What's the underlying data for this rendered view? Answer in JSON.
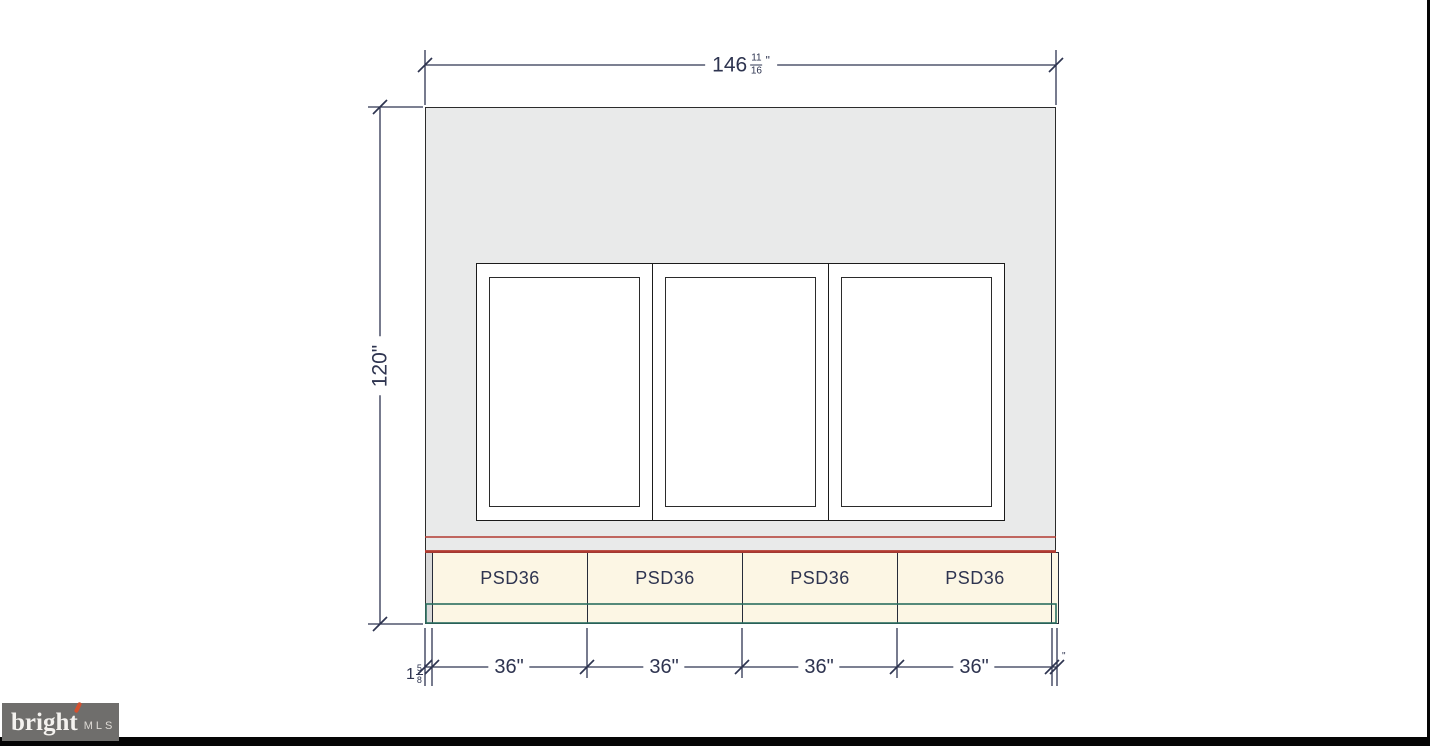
{
  "drawing": {
    "colors": {
      "dim_line": "#2e3450",
      "red_accent": "#b23b31",
      "teal_accent": "#2a6e5f",
      "wall_fill": "#e9eaea",
      "cabinet_fill": "#fcf6e4"
    },
    "dimensions": {
      "top_width": {
        "whole": "146",
        "numerator": "11",
        "denominator": "16",
        "unit": "\""
      },
      "wall_height": "120\"",
      "cabinet_widths": [
        "36\"",
        "36\"",
        "36\"",
        "36\""
      ],
      "left_filler": {
        "whole": "1",
        "numerator": "5",
        "denominator": "8",
        "unit": "\""
      },
      "right_filler_mark": "\""
    },
    "cabinets": [
      {
        "label": "PSD36"
      },
      {
        "label": "PSD36"
      },
      {
        "label": "PSD36"
      },
      {
        "label": "PSD36"
      }
    ]
  },
  "watermark": {
    "brand": "bright",
    "suffix": "MLS",
    "accent_color": "#d4502e"
  }
}
